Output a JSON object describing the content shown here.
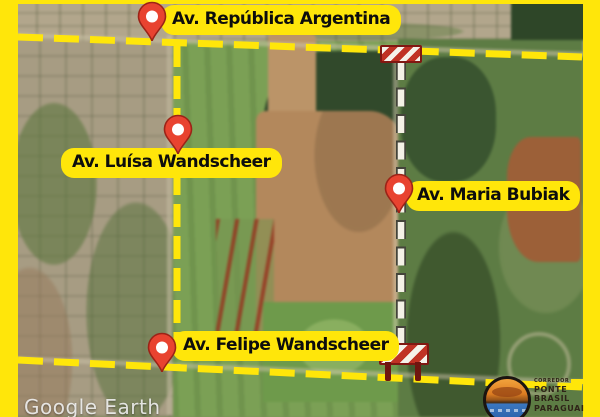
{
  "labels": {
    "republica": "Av. República Argentina",
    "luisa": "Av. Luísa Wandscheer",
    "maria": "Av. Maria Bubiak",
    "felipe": "Av. Felipe Wandscheer"
  },
  "watermark": "Google Earth",
  "logo": {
    "eyebrow": "CORREDOR",
    "line1": "PONTE",
    "line2": "BRASIL",
    "line3": "PARAGUAI"
  },
  "colors": {
    "accent_yellow": "#ffe60a",
    "pin_red": "#e84330",
    "barrier_red": "#c03224",
    "route_white": "#f4f1e6"
  }
}
